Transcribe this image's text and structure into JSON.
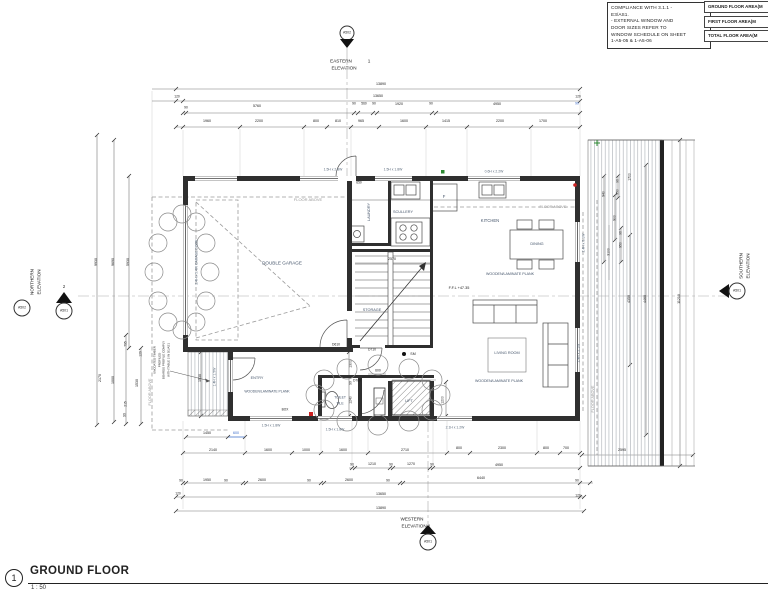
{
  "notes": {
    "compliance": "COMPLIANCE WITH 3.1.1 -\nE3/AS1.\n- EXTERNAL WINDOW AND\nDOOR SIZES REFER TO\nWINDOW SCHEDULE ON SHEET\n1-A5-05 & 1-A5-06"
  },
  "area_table": {
    "rows": [
      "GROUND FLOOR AREA(M",
      "FIRST FLOOR AREA(M",
      "TOTAL FLOOR AREA(M"
    ]
  },
  "title_block": {
    "number": "1",
    "title": "GROUND FLOOR",
    "scale": "1 : 50"
  },
  "colors": {
    "dim": "#1a1a1a",
    "room": "#44546a",
    "gray": "#9a9a9a",
    "win": "#5b6b7d",
    "blue": "#3a6bc9",
    "wall": "#2f2f2f",
    "accent_red": "#cc2222",
    "accent_green": "#2d8a33"
  },
  "labels": [
    {
      "n": "elevation-marker-label-east",
      "t": "A502",
      "x": 347,
      "y": 33,
      "s": 3.4
    },
    {
      "n": "elevation-label-eastern",
      "t": "EASTERN",
      "x": 341,
      "y": 62,
      "s": 4.6
    },
    {
      "n": "elevation-number-eastern",
      "t": "1",
      "x": 369,
      "y": 62,
      "s": 4.6
    },
    {
      "n": "elevation-label-eastern-word2",
      "t": "ELEVATION",
      "x": 344,
      "y": 69,
      "s": 4.6
    },
    {
      "n": "elevation-label-northern",
      "t": "NORTHERN",
      "x": 33,
      "y": 282,
      "s": 4.6,
      "r": -90
    },
    {
      "n": "elevation-label-northern-word2",
      "t": "ELEVATION",
      "x": 40,
      "y": 282,
      "s": 4.6,
      "r": -90
    },
    {
      "n": "elevation-marker-label-north",
      "t": "A502",
      "x": 22,
      "y": 308,
      "s": 3.4
    },
    {
      "n": "section-number-north",
      "t": "2",
      "x": 64,
      "y": 287,
      "s": 4.2
    },
    {
      "n": "elevation-marker-label-north-2",
      "t": "A501",
      "x": 64,
      "y": 311,
      "s": 3.4
    },
    {
      "n": "elevation-label-southern",
      "t": "SOUTHERN",
      "x": 742,
      "y": 266,
      "s": 4.6,
      "r": -90
    },
    {
      "n": "elevation-label-southern-word2",
      "t": "ELEVATION",
      "x": 749,
      "y": 266,
      "s": 4.6,
      "r": -90
    },
    {
      "n": "elevation-marker-label-south",
      "t": "A501",
      "x": 737,
      "y": 291,
      "s": 3.4
    },
    {
      "n": "elevation-label-western",
      "t": "WESTERN",
      "x": 412,
      "y": 520,
      "s": 4.6
    },
    {
      "n": "elevation-label-western-word2",
      "t": "ELEVATION 1",
      "x": 416,
      "y": 527,
      "s": 4.6
    },
    {
      "n": "elevation-marker-label-west",
      "t": "A501",
      "x": 428,
      "y": 542,
      "s": 3.4
    },
    {
      "n": "room-double-garage",
      "t": "DOUBLE GARAGE",
      "x": 282,
      "y": 264,
      "s": 4.6,
      "c": "room"
    },
    {
      "n": "floor-above-garage",
      "t": "FLOOR ABOVE",
      "x": 308,
      "y": 200,
      "s": 4,
      "c": "gray"
    },
    {
      "n": "room-laundry",
      "t": "LAUNDRY",
      "x": 370,
      "y": 212,
      "s": 3.8,
      "c": "room",
      "r": -90
    },
    {
      "n": "room-scullery",
      "t": "SCULLERY",
      "x": 403,
      "y": 213,
      "s": 3.8,
      "c": "room"
    },
    {
      "n": "room-kitchen",
      "t": "KITCHEN",
      "x": 490,
      "y": 221,
      "s": 4.2,
      "c": "room"
    },
    {
      "n": "room-dining",
      "t": "DINING",
      "x": 537,
      "y": 245,
      "s": 3.8,
      "c": "room"
    },
    {
      "n": "floor-above-kitchen",
      "t": "FLOOR ABOVE",
      "x": 553,
      "y": 208,
      "s": 3.8,
      "c": "gray"
    },
    {
      "n": "floor-label-kitchen",
      "t": "WOODEN/LAMINATE PLANK",
      "x": 510,
      "y": 275,
      "s": 3.6,
      "c": "room"
    },
    {
      "n": "ffl-level",
      "t": "F.F.L +47.35",
      "x": 459,
      "y": 289,
      "s": 3.8
    },
    {
      "n": "room-storage",
      "t": "STORAGE",
      "x": 372,
      "y": 311,
      "s": 3.8,
      "c": "room"
    },
    {
      "n": "room-living",
      "t": "LIVING ROOM",
      "x": 507,
      "y": 354,
      "s": 3.8,
      "c": "room"
    },
    {
      "n": "floor-label-living",
      "t": "WOODEN/LAMINATE PLANK",
      "x": 499,
      "y": 382,
      "s": 3.6,
      "c": "room"
    },
    {
      "n": "room-entry",
      "t": "ENTRY",
      "x": 257,
      "y": 379,
      "s": 3.8,
      "c": "room"
    },
    {
      "n": "floor-label-entry",
      "t": "WOODEN/LAMINATE PLANK",
      "x": 267,
      "y": 392,
      "s": 3.4,
      "c": "room"
    },
    {
      "n": "room-toilet",
      "t": "TOILET",
      "x": 340,
      "y": 398,
      "s": 3.4,
      "c": "room"
    },
    {
      "n": "room-toilet-tile",
      "t": "TILE",
      "x": 340,
      "y": 404,
      "s": 3.4,
      "c": "room"
    },
    {
      "n": "room-lift",
      "t": "LIFT",
      "x": 409,
      "y": 402,
      "s": 3.8,
      "c": "room"
    },
    {
      "n": "smoke-alarm-label",
      "t": "SM",
      "x": 413,
      "y": 355,
      "s": 3.6
    },
    {
      "n": "box-label",
      "t": "BOX",
      "x": 285,
      "y": 410,
      "s": 3.2
    },
    {
      "n": "door-tag-d610",
      "t": "D610",
      "x": 336,
      "y": 345,
      "s": 3.4
    },
    {
      "n": "door-tag-d710",
      "t": "D710",
      "x": 372,
      "y": 350,
      "s": 3.4
    },
    {
      "n": "door-tag-d760",
      "t": "D760",
      "x": 357,
      "y": 381,
      "s": 3.4
    },
    {
      "n": "fridge-label",
      "t": "F",
      "x": 444,
      "y": 197,
      "s": 4.2,
      "c": "room"
    },
    {
      "n": "floor-above-left",
      "t": "FLOOR ABOVE",
      "x": 151,
      "y": 392,
      "s": 3.8,
      "c": "gray",
      "r": -90
    },
    {
      "n": "floor-above-right",
      "t": "FLOOR ABOVE",
      "x": 594,
      "y": 399,
      "s": 3.8,
      "c": "gray",
      "r": -90
    },
    {
      "n": "garage-door-note",
      "t": "2.4H x 5.4W GARAGE DOOR",
      "x": 197,
      "y": 262,
      "s": 3.4,
      "c": "win",
      "r": -90
    },
    {
      "n": "timber-note-line1",
      "t": "UNCOATED TIMBER",
      "x": 155,
      "y": 360,
      "s": 2.9,
      "r": -90
    },
    {
      "n": "timber-note-line2",
      "t": "PROFILED",
      "x": 159.5,
      "y": 360,
      "s": 2.9,
      "r": -90
    },
    {
      "n": "timber-note-line3",
      "t": "BOARDS PROFILE COMPLY",
      "x": 164,
      "y": 360,
      "s": 2.9,
      "r": -90
    },
    {
      "n": "timber-note-line4",
      "t": "WITH TABLE 2 IN D1/AS1",
      "x": 168.5,
      "y": 360,
      "s": 2.9,
      "r": -90
    },
    {
      "n": "window-size-label",
      "t": "1.5H x 2.8W",
      "x": 333,
      "y": 170,
      "s": 3.4,
      "c": "win"
    },
    {
      "n": "window-size-label",
      "t": "1.5H x 1.8W",
      "x": 393,
      "y": 170,
      "s": 3.4,
      "c": "win"
    },
    {
      "n": "window-size-label",
      "t": "0.6H x 2.2W",
      "x": 494,
      "y": 172,
      "s": 3.4,
      "c": "win"
    },
    {
      "n": "window-size-label",
      "t": "1.5H x 1.8W",
      "x": 271,
      "y": 426,
      "s": 3.4,
      "c": "win"
    },
    {
      "n": "window-size-label",
      "t": "1.5H x 1.8W",
      "x": 335,
      "y": 430,
      "s": 3.4,
      "c": "win"
    },
    {
      "n": "window-size-label",
      "t": "2.1H x 1.2W",
      "x": 455,
      "y": 428,
      "s": 3.4,
      "c": "win"
    },
    {
      "n": "window-size-label",
      "t": "1.4H x 1.5W",
      "x": 215,
      "y": 377,
      "s": 3.4,
      "c": "win",
      "r": -90
    },
    {
      "n": "window-size-label",
      "t": "2.4H x 5.1W",
      "x": 584,
      "y": 243,
      "s": 3.4,
      "c": "win",
      "r": -90
    },
    {
      "n": "window-size-label",
      "t": "2.4H x 2.1W",
      "x": 579,
      "y": 353,
      "s": 3.4,
      "c": "win",
      "r": -90
    },
    {
      "n": "dim-overall-top",
      "t": "13890",
      "x": 381,
      "y": 85,
      "s": 3.6
    },
    {
      "n": "dim",
      "t": "120",
      "x": 177,
      "y": 97,
      "s": 3.3
    },
    {
      "n": "dim",
      "t": "13650",
      "x": 378,
      "y": 97,
      "s": 3.6
    },
    {
      "n": "dim",
      "t": "120",
      "x": 578,
      "y": 97,
      "s": 3.3
    },
    {
      "n": "dim",
      "t": "90",
      "x": 186,
      "y": 108,
      "s": 3.3
    },
    {
      "n": "dim",
      "t": "5760",
      "x": 257,
      "y": 107,
      "s": 3.6
    },
    {
      "n": "dim",
      "t": "90",
      "x": 354,
      "y": 104,
      "s": 3.3
    },
    {
      "n": "dim",
      "t": "560",
      "x": 364,
      "y": 104,
      "s": 3.3
    },
    {
      "n": "dim",
      "t": "90",
      "x": 374,
      "y": 104,
      "s": 3.3
    },
    {
      "n": "dim",
      "t": "1920",
      "x": 399,
      "y": 105,
      "s": 3.6
    },
    {
      "n": "dim",
      "t": "90",
      "x": 431,
      "y": 104,
      "s": 3.3
    },
    {
      "n": "dim",
      "t": "4950",
      "x": 497,
      "y": 105,
      "s": 3.6
    },
    {
      "n": "dim",
      "t": "90",
      "x": 577,
      "y": 104,
      "s": 3.3,
      "c": "blue"
    },
    {
      "n": "dim",
      "t": "1960",
      "x": 207,
      "y": 122,
      "s": 3.6
    },
    {
      "n": "dim",
      "t": "2200",
      "x": 259,
      "y": 122,
      "s": 3.6
    },
    {
      "n": "dim",
      "t": "800",
      "x": 316,
      "y": 122,
      "s": 3.6
    },
    {
      "n": "dim",
      "t": "810",
      "x": 338,
      "y": 122,
      "s": 3.6
    },
    {
      "n": "dim",
      "t": "965",
      "x": 361,
      "y": 122,
      "s": 3.6
    },
    {
      "n": "dim",
      "t": "1600",
      "x": 404,
      "y": 122,
      "s": 3.6
    },
    {
      "n": "dim",
      "t": "1415",
      "x": 446,
      "y": 122,
      "s": 3.6
    },
    {
      "n": "dim",
      "t": "2200",
      "x": 500,
      "y": 122,
      "s": 3.6
    },
    {
      "n": "dim",
      "t": "1700",
      "x": 543,
      "y": 122,
      "s": 3.6
    },
    {
      "n": "dim",
      "t": "1450",
      "x": 207,
      "y": 434,
      "s": 3.6
    },
    {
      "n": "dim",
      "t": "600",
      "x": 236,
      "y": 434,
      "s": 3.6,
      "c": "blue"
    },
    {
      "n": "dim",
      "t": "2140",
      "x": 213,
      "y": 451,
      "s": 3.6
    },
    {
      "n": "dim",
      "t": "1600",
      "x": 268,
      "y": 451,
      "s": 3.6
    },
    {
      "n": "dim",
      "t": "1000",
      "x": 306,
      "y": 451,
      "s": 3.6
    },
    {
      "n": "dim",
      "t": "1600",
      "x": 343,
      "y": 451,
      "s": 3.6
    },
    {
      "n": "dim",
      "t": "2710",
      "x": 405,
      "y": 451,
      "s": 3.6
    },
    {
      "n": "dim",
      "t": "800",
      "x": 459,
      "y": 449,
      "s": 3.6
    },
    {
      "n": "dim",
      "t": "2300",
      "x": 502,
      "y": 449,
      "s": 3.6
    },
    {
      "n": "dim",
      "t": "800",
      "x": 546,
      "y": 449,
      "s": 3.6
    },
    {
      "n": "dim",
      "t": "700",
      "x": 566,
      "y": 449,
      "s": 3.6
    },
    {
      "n": "dim",
      "t": "2595",
      "x": 622,
      "y": 451,
      "s": 3.6
    },
    {
      "n": "dim",
      "t": "90",
      "x": 352,
      "y": 465,
      "s": 3.3
    },
    {
      "n": "dim",
      "t": "1210",
      "x": 372,
      "y": 465,
      "s": 3.6
    },
    {
      "n": "dim",
      "t": "90",
      "x": 391,
      "y": 465,
      "s": 3.3
    },
    {
      "n": "dim",
      "t": "1270",
      "x": 411,
      "y": 465,
      "s": 3.6
    },
    {
      "n": "dim",
      "t": "90",
      "x": 432,
      "y": 465,
      "s": 3.3
    },
    {
      "n": "dim",
      "t": "4950",
      "x": 499,
      "y": 466,
      "s": 3.6
    },
    {
      "n": "dim",
      "t": "90",
      "x": 181,
      "y": 481,
      "s": 3.3
    },
    {
      "n": "dim",
      "t": "1950",
      "x": 207,
      "y": 481,
      "s": 3.6
    },
    {
      "n": "dim",
      "t": "90",
      "x": 226,
      "y": 481,
      "s": 3.3
    },
    {
      "n": "dim",
      "t": "2600",
      "x": 262,
      "y": 481,
      "s": 3.6
    },
    {
      "n": "dim",
      "t": "90",
      "x": 309,
      "y": 481,
      "s": 3.3
    },
    {
      "n": "dim",
      "t": "2600",
      "x": 349,
      "y": 481,
      "s": 3.6
    },
    {
      "n": "dim",
      "t": "90",
      "x": 388,
      "y": 481,
      "s": 3.3
    },
    {
      "n": "dim",
      "t": "6440",
      "x": 481,
      "y": 479,
      "s": 3.6
    },
    {
      "n": "dim",
      "t": "90",
      "x": 577,
      "y": 481,
      "s": 3.3
    },
    {
      "n": "dim",
      "t": "120",
      "x": 178,
      "y": 494,
      "s": 3.3
    },
    {
      "n": "dim",
      "t": "13650",
      "x": 381,
      "y": 495,
      "s": 3.6
    },
    {
      "n": "dim",
      "t": "120",
      "x": 578,
      "y": 496,
      "s": 3.3
    },
    {
      "n": "dim-overall-bottom",
      "t": "13890",
      "x": 381,
      "y": 509,
      "s": 3.6
    },
    {
      "n": "dim",
      "t": "9930",
      "x": 97,
      "y": 262,
      "s": 3.6,
      "r": -90
    },
    {
      "n": "dim",
      "t": "9690",
      "x": 114,
      "y": 262,
      "s": 3.6,
      "r": -90
    },
    {
      "n": "dim",
      "t": "5930",
      "x": 129,
      "y": 262,
      "s": 3.6,
      "r": -90
    },
    {
      "n": "dim",
      "t": "2170",
      "x": 101,
      "y": 378,
      "s": 3.6,
      "r": -90
    },
    {
      "n": "dim",
      "t": "1000",
      "x": 114,
      "y": 380,
      "s": 3.6,
      "r": -90
    },
    {
      "n": "dim",
      "t": "795",
      "x": 126,
      "y": 344,
      "s": 3.3,
      "r": -90
    },
    {
      "n": "dim",
      "t": "120",
      "x": 141,
      "y": 354,
      "s": 3.3,
      "r": -90
    },
    {
      "n": "dim",
      "t": "1530",
      "x": 138,
      "y": 383,
      "s": 3.6,
      "r": -90
    },
    {
      "n": "dim",
      "t": "215",
      "x": 126,
      "y": 404,
      "s": 3.3,
      "r": -90
    },
    {
      "n": "dim",
      "t": "90",
      "x": 125,
      "y": 415,
      "s": 3.3,
      "r": -90
    },
    {
      "n": "dim",
      "t": "1530",
      "x": 201,
      "y": 378,
      "s": 3.6,
      "r": -90
    },
    {
      "n": "dim",
      "t": "650",
      "x": 359,
      "y": 183,
      "s": 3.3
    },
    {
      "n": "dim",
      "t": "2570",
      "x": 392,
      "y": 260,
      "s": 3.6
    },
    {
      "n": "dim",
      "t": "1300",
      "x": 351,
      "y": 364,
      "s": 3.4,
      "r": -90
    },
    {
      "n": "dim",
      "t": "90",
      "x": 351,
      "y": 383,
      "s": 3.3,
      "r": -90
    },
    {
      "n": "dim",
      "t": "1240",
      "x": 351,
      "y": 400,
      "s": 3.4,
      "r": -90
    },
    {
      "n": "dim",
      "t": "600",
      "x": 378,
      "y": 371,
      "s": 3.4
    },
    {
      "n": "dim",
      "t": "1370",
      "x": 414,
      "y": 377,
      "s": 3.4
    },
    {
      "n": "dim",
      "t": "1200",
      "x": 443,
      "y": 400,
      "s": 3.4,
      "r": -90
    },
    {
      "n": "dim",
      "t": "940",
      "x": 604,
      "y": 194,
      "s": 3.4,
      "r": -90
    },
    {
      "n": "dim",
      "t": "90",
      "x": 618,
      "y": 181,
      "s": 3.2,
      "r": -90
    },
    {
      "n": "dim",
      "t": "550",
      "x": 618,
      "y": 192,
      "s": 3.4,
      "r": -90
    },
    {
      "n": "dim",
      "t": "1700",
      "x": 630,
      "y": 177,
      "s": 3.4,
      "r": -90
    },
    {
      "n": "dim",
      "t": "900",
      "x": 615,
      "y": 218,
      "s": 3.4,
      "r": -90
    },
    {
      "n": "dim",
      "t": "90",
      "x": 621,
      "y": 233,
      "s": 3.2,
      "r": -90
    },
    {
      "n": "dim",
      "t": "950",
      "x": 621,
      "y": 245,
      "s": 3.4,
      "r": -90
    },
    {
      "n": "dim",
      "t": "3100",
      "x": 609,
      "y": 252,
      "s": 3.4,
      "r": -90
    },
    {
      "n": "dim",
      "t": "4350",
      "x": 630,
      "y": 299,
      "s": 3.6,
      "r": -90
    },
    {
      "n": "dim",
      "t": "4460",
      "x": 646,
      "y": 299,
      "s": 3.6,
      "r": -90
    },
    {
      "n": "dim",
      "t": "11210",
      "x": 680,
      "y": 299,
      "s": 3.6,
      "r": -90
    }
  ]
}
